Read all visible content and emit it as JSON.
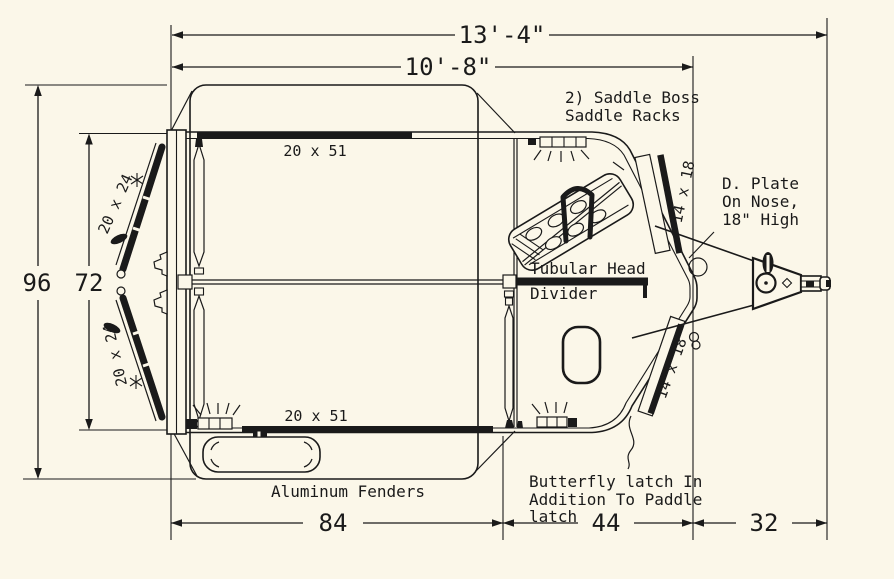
{
  "colors": {
    "background": "#fbf7e9",
    "line": "#1a1a1a"
  },
  "dimensions": {
    "overall_length": "13'-4\"",
    "body_length": "10'-8\"",
    "overall_width": "96",
    "interior_width": "72",
    "box_length": "84",
    "nose_length": "44",
    "tongue_length": "32"
  },
  "labels": {
    "saddle_racks_line1": "2) Saddle Boss",
    "saddle_racks_line2": "Saddle Racks",
    "d_plate_line1": "D. Plate",
    "d_plate_line2": "On Nose,",
    "d_plate_line3": "18\" High",
    "head_divider_line1": "Tubular Head",
    "head_divider_line2": "Divider",
    "fenders": "Aluminum Fenders",
    "butterfly_line1": "Butterfly latch In",
    "butterfly_line2": "Addition To Paddle",
    "butterfly_line3": "latch",
    "top_window": "20 x 51",
    "bottom_window": "20 x 51",
    "left_upper_window": "20 x 24",
    "left_lower_window": "20 x 24",
    "right_upper_window": "14 x 18",
    "right_lower_window": "14 x 18"
  }
}
